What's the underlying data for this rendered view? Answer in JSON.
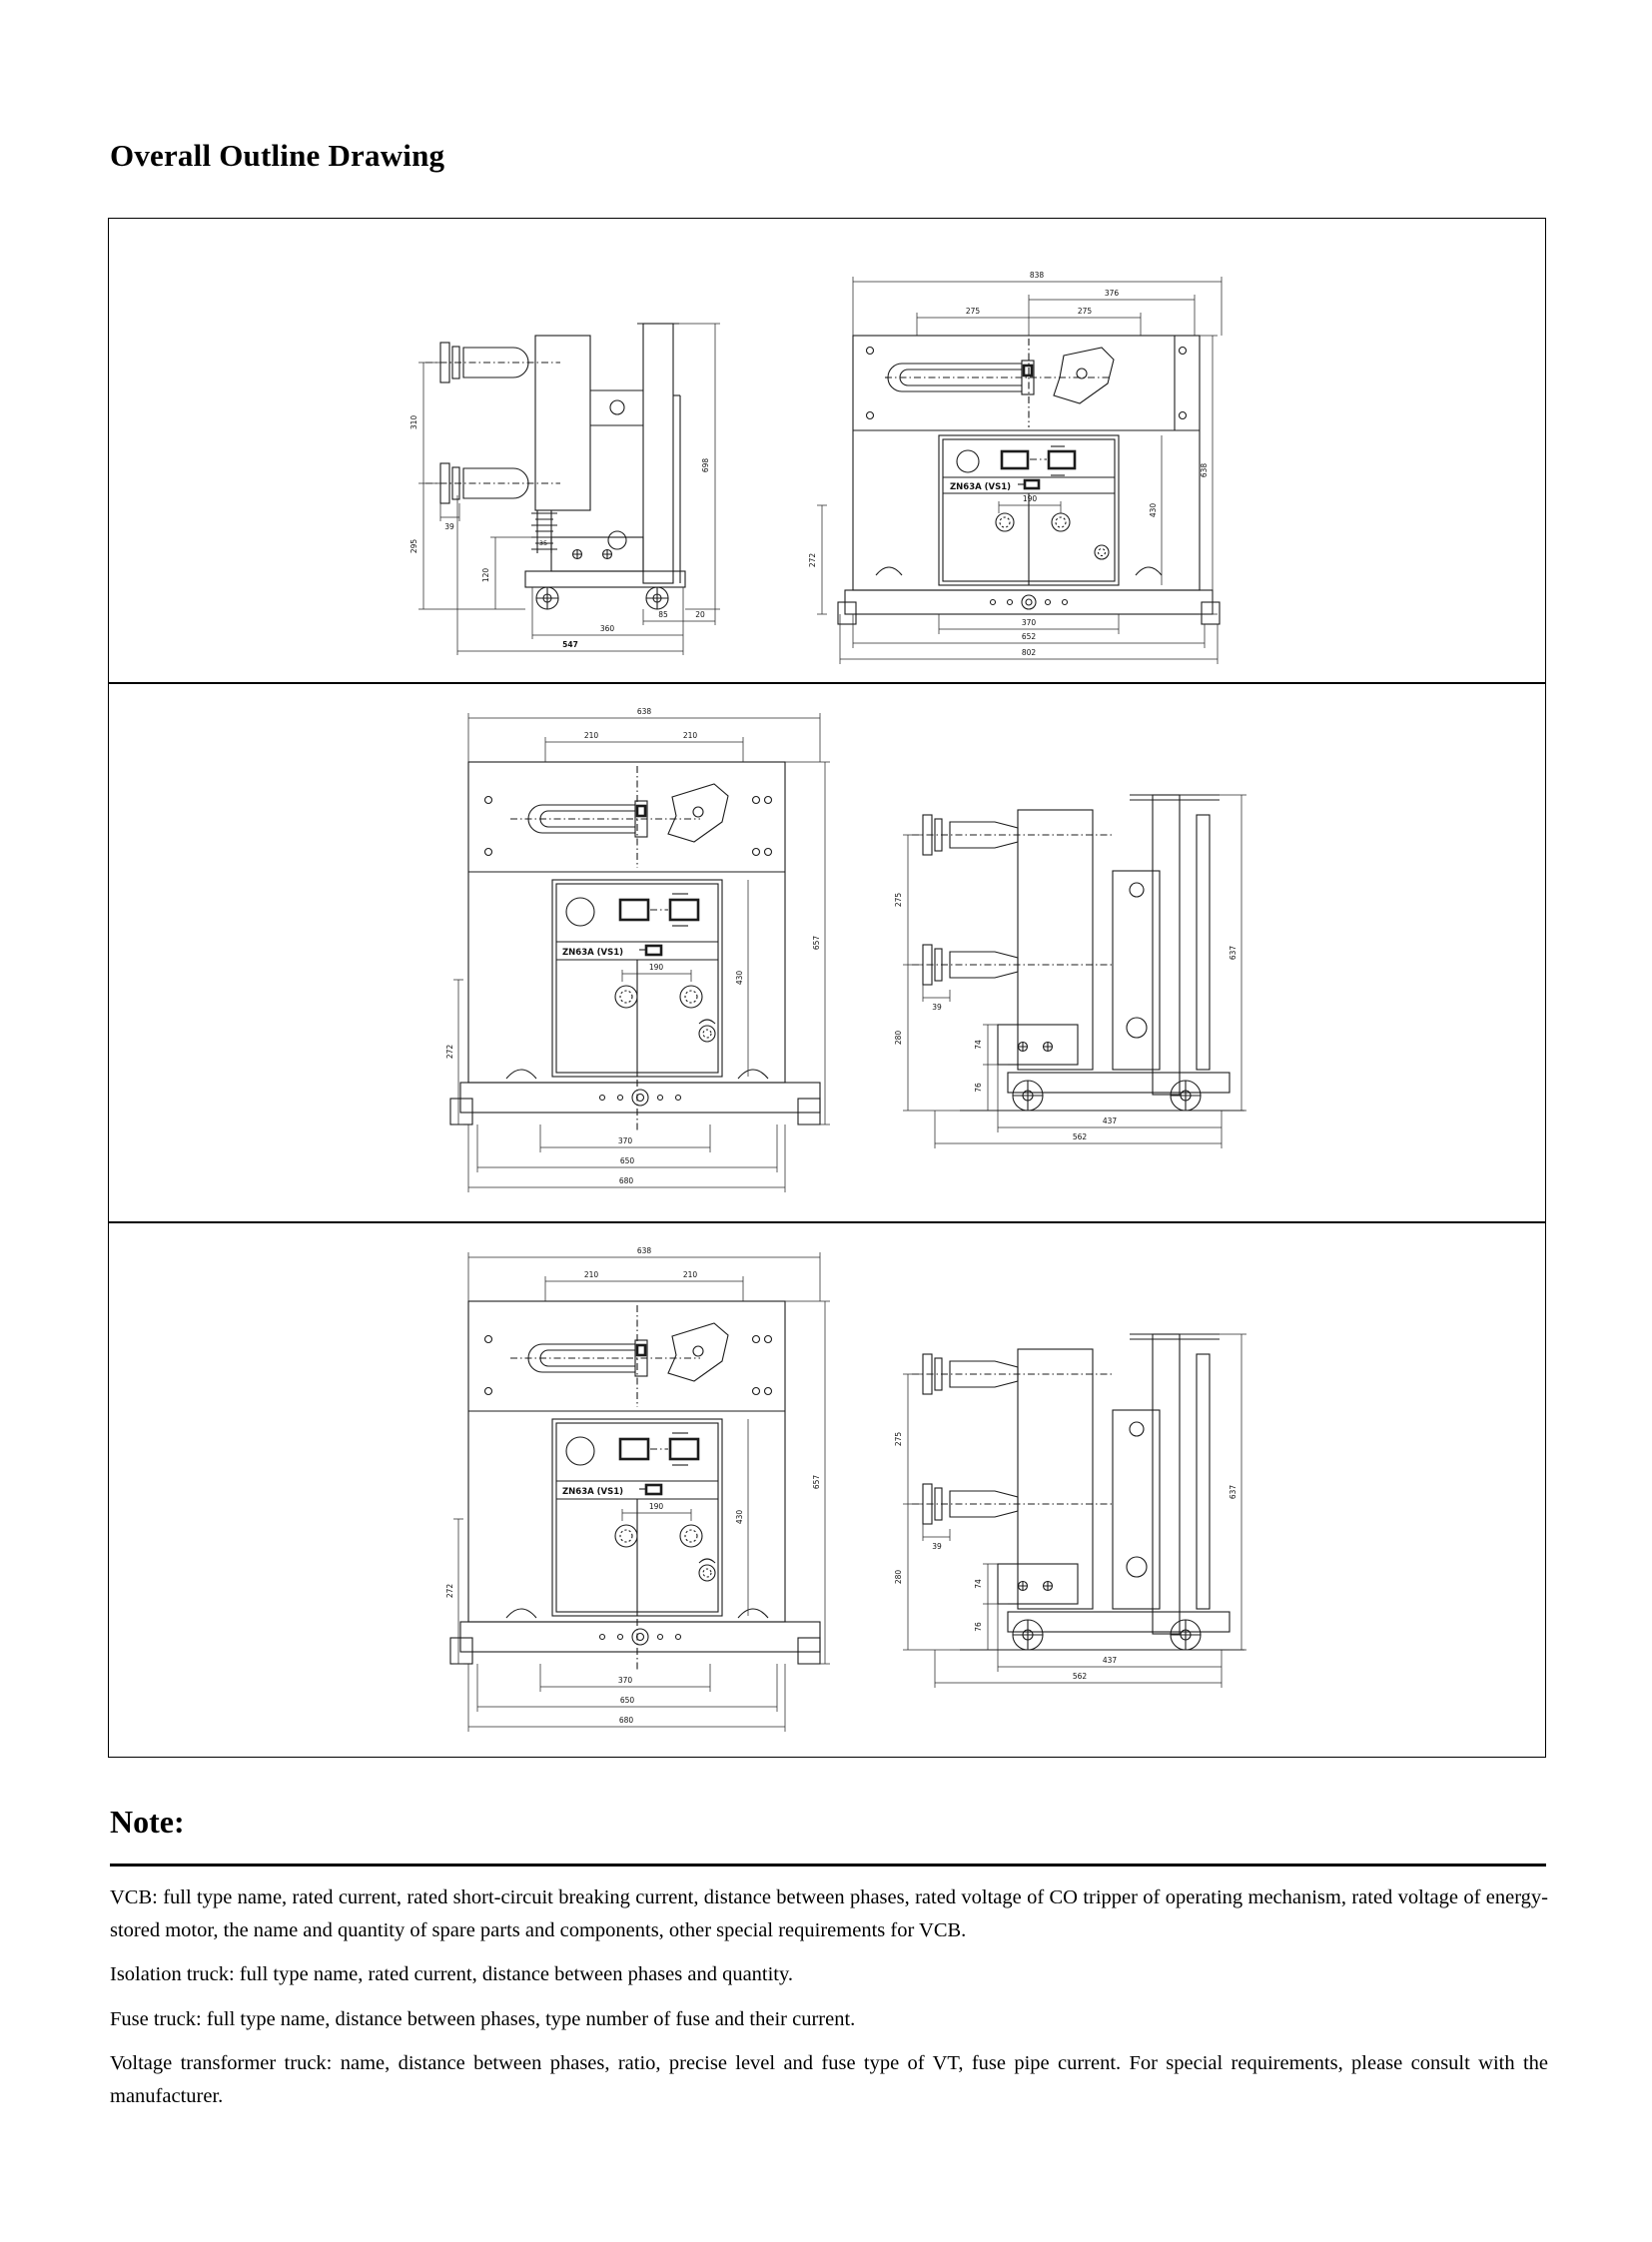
{
  "page": {
    "title": "Overall Outline Drawing"
  },
  "note": {
    "heading": "Note:",
    "items": [
      "VCB: full type name, rated current, rated short-circuit breaking current, distance between phases, rated voltage of CO tripper of operating mechanism, rated voltage of energy-stored motor, the name and quantity of spare parts and components, other special requirements for VCB.",
      "Isolation truck: full type name, rated current, distance between phases and quantity.",
      "Fuse truck: full type name, distance between phases, type number of fuse and their current.",
      "Voltage transformer truck: name, distance between phases, ratio, precise level and fuse type of VT, fuse pipe current. For special requirements, please consult with the manufacturer."
    ]
  },
  "drawings": {
    "row1_side": {
      "dims": {
        "v1": "310",
        "v2": "295",
        "v3": "120",
        "offset": "39",
        "inner": "35",
        "h_total": "698",
        "b_wheel": "85",
        "b_edge": "20",
        "b_inner": "360",
        "b_total": "547"
      }
    },
    "row1_front": {
      "nameplate": "ZN63A (VS1)",
      "dims": {
        "w_total": "838",
        "w_sub": "376",
        "pole1": "275",
        "pole2": "275",
        "left": "272",
        "panel": "430",
        "h_total": "638",
        "btn": "190",
        "b1": "370",
        "b2": "652",
        "b3": "802"
      }
    },
    "row2_front": {
      "nameplate": "ZN63A (VS1)",
      "dims": {
        "w_total": "638",
        "pole1": "210",
        "pole2": "210",
        "left": "272",
        "panel": "430",
        "h_total": "657",
        "btn": "190",
        "b1": "370",
        "b2": "650",
        "b3": "680"
      }
    },
    "row2_side": {
      "dims": {
        "v1": "275",
        "offset": "39",
        "v2": "280",
        "v3": "74",
        "v4": "76",
        "h_total": "637",
        "b1": "437",
        "b2": "562"
      }
    },
    "row3_front": {
      "nameplate": "ZN63A (VS1)",
      "dims": {
        "w_total": "638",
        "pole1": "210",
        "pole2": "210",
        "left": "272",
        "panel": "430",
        "h_total": "657",
        "btn": "190",
        "b1": "370",
        "b2": "650",
        "b3": "680"
      }
    },
    "row3_side": {
      "dims": {
        "v1": "275",
        "offset": "39",
        "v2": "280",
        "v3": "74",
        "v4": "76",
        "h_total": "637",
        "b1": "437",
        "b2": "562"
      }
    }
  }
}
